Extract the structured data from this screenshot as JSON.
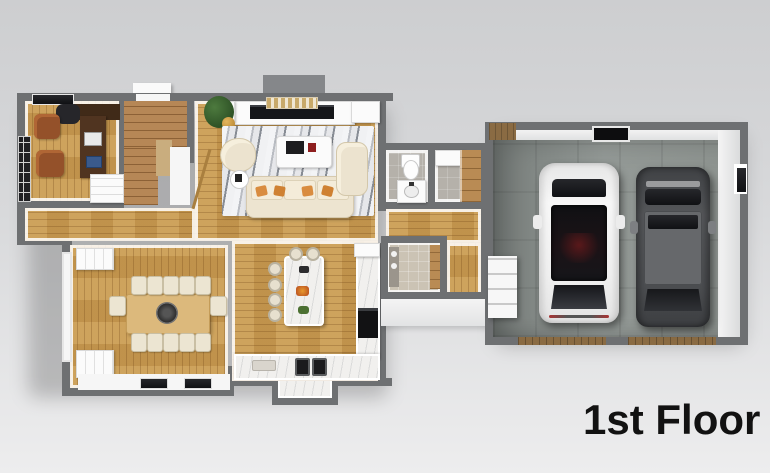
{
  "title": "1st Floor",
  "colors": {
    "background_top": "#cdced0",
    "background_bottom": "#ededee",
    "wall": "#6e7072",
    "wood_floor": "#c69950",
    "stair_wood": "#b68756",
    "tile": "#b5b1aa",
    "marble": "#f1f0ee",
    "concrete": "#8d938f",
    "garage_door": "#8a6b43",
    "car_white": "#f1f1f1",
    "car_dark": "#4e5052",
    "text": "#121212"
  },
  "scene": {
    "floors_shown": 1,
    "rooms": [
      {
        "name": "office",
        "items": [
          "desk",
          "desk-chair",
          "laptop",
          "two-leather-armchairs",
          "french-door",
          "window",
          "closet"
        ]
      },
      {
        "name": "staircase",
        "items": [
          "l-shaped-stairs",
          "banister",
          "front-stoop"
        ]
      },
      {
        "name": "living-room",
        "items": [
          "fireplace-media-wall",
          "marble-area-rug",
          "coffee-table",
          "cream-sofa",
          "chaise",
          "accent-chair",
          "potted-plant",
          "side-tables"
        ]
      },
      {
        "name": "dining-room",
        "items": [
          "wood-dining-table",
          "twelve-chairs",
          "centerpiece",
          "buffet-cabinet",
          "bay-window-bench",
          "side-windows"
        ]
      },
      {
        "name": "kitchen",
        "items": [
          "marble-island",
          "six-bar-stools",
          "double-basin-sink",
          "wall-oven",
          "counters",
          "window-nook"
        ]
      },
      {
        "name": "bathroom",
        "items": [
          "toilet",
          "vanity-sink"
        ]
      },
      {
        "name": "closet",
        "items": [
          "wood-shelving",
          "cabinet"
        ]
      },
      {
        "name": "laundry-room",
        "items": [
          "appliances",
          "wood-counter"
        ]
      },
      {
        "name": "garage",
        "items": [
          "white-car",
          "gray-car",
          "entry-steps",
          "attic-hatch",
          "window",
          "storage-shelf",
          "two-garage-door-thresholds"
        ]
      }
    ]
  }
}
